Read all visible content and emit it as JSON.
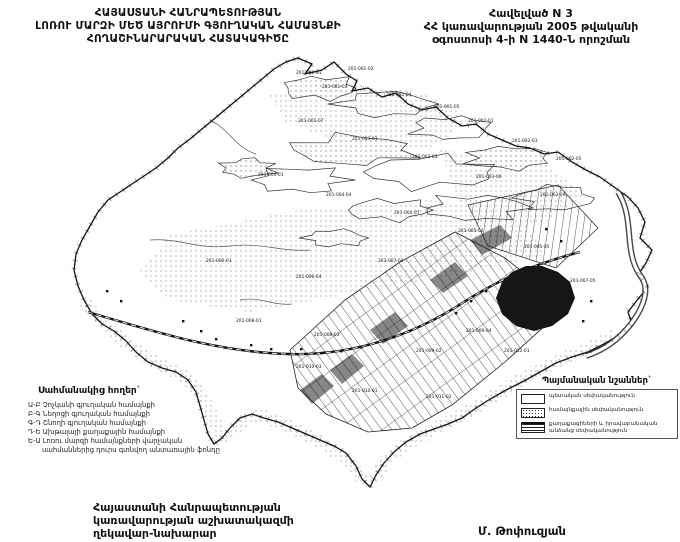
{
  "colors": {
    "ink": "#111111",
    "paper": "#ffffff",
    "map_gray": "#333333"
  },
  "header_left": {
    "lines": [
      "ՀԱՅԱՍՏԱՆԻ ՀԱՆՐԱՊԵՏՈՒԹՅԱՆ",
      "ԼՈՌՈՒ ՄԱՐԶԻ ՄԵԾ ԱՅՐՈՒՄԻ ԳՅՈՒՂԱԿԱՆ ՀԱՄԱՅՆՔԻ",
      "ՀՈՂԱՇԻՆԱՐԱՐԱԿԱՆ ՀԱՏԱԿԱԳԻԾԸ"
    ]
  },
  "header_right": {
    "lines": [
      "Հավելված N 3",
      "ՀՀ կառավարության 2005 թվականի",
      "օգոստոսի 4-ի N 1440-Ն որոշման"
    ]
  },
  "legend_border": {
    "heading": "Սահմանակից հողեր`",
    "items": [
      "Ա-Բ  Չոչկանի գյուղական համայնքի",
      "Բ-Գ  Նեղոցի գյուղական համայնքի",
      "Գ-Դ  Շնողի գյուղական համայնքի",
      "Դ-Ե  Ախթալայի քաղաքային համայնքի",
      "Ե-Ա  Լոռու մարզի համայնքների վարչական",
      "սահմաններից դուրս գտնվող անտառային ֆոնդը"
    ]
  },
  "legend_signs": {
    "heading": "Պայմանական նշաններ`",
    "items": [
      {
        "symbol": "state",
        "label": "պետական սեփականություն"
      },
      {
        "symbol": "community",
        "label": "համայնքային սեփականություն"
      },
      {
        "symbol": "private",
        "label": "քաղաքացիների և իրավաբանական անձանց սեփականություն"
      }
    ]
  },
  "footer": {
    "lines": [
      "Հայաստանի Հանրապետության",
      "կառավարության աշխատակազմի",
      "ղեկավար-նախարար"
    ]
  },
  "signature": "Մ. Թոփուզյան",
  "map": {
    "labels": [
      {
        "text": "201-001-01",
        "x": 296,
        "y": 74
      },
      {
        "text": "201-001-02",
        "x": 348,
        "y": 70
      },
      {
        "text": "201-001-03",
        "x": 322,
        "y": 88
      },
      {
        "text": "201-001-04",
        "x": 386,
        "y": 96
      },
      {
        "text": "201-001-05",
        "x": 434,
        "y": 108
      },
      {
        "text": "201-002-01",
        "x": 468,
        "y": 122
      },
      {
        "text": "201-002-03",
        "x": 512,
        "y": 142
      },
      {
        "text": "201-002-05",
        "x": 556,
        "y": 160
      },
      {
        "text": "201-001-07",
        "x": 298,
        "y": 122
      },
      {
        "text": "201-003-01",
        "x": 352,
        "y": 140
      },
      {
        "text": "201-003-03",
        "x": 412,
        "y": 158
      },
      {
        "text": "201-003-06",
        "x": 476,
        "y": 178
      },
      {
        "text": "201-003-09",
        "x": 540,
        "y": 196
      },
      {
        "text": "201-004-01",
        "x": 258,
        "y": 176
      },
      {
        "text": "201-004-04",
        "x": 326,
        "y": 196
      },
      {
        "text": "201-004-07",
        "x": 394,
        "y": 214
      },
      {
        "text": "201-005-02",
        "x": 458,
        "y": 232
      },
      {
        "text": "201-005-05",
        "x": 524,
        "y": 248
      },
      {
        "text": "201-006-01",
        "x": 206,
        "y": 262
      },
      {
        "text": "201-006-04",
        "x": 296,
        "y": 278
      },
      {
        "text": "201-007-02",
        "x": 378,
        "y": 262
      },
      {
        "text": "201-007-05",
        "x": 570,
        "y": 282
      },
      {
        "text": "201-008-01",
        "x": 236,
        "y": 322
      },
      {
        "text": "201-008-03",
        "x": 314,
        "y": 336
      },
      {
        "text": "201-009-02",
        "x": 416,
        "y": 352
      },
      {
        "text": "201-009-04",
        "x": 466,
        "y": 332
      },
      {
        "text": "201-010-01",
        "x": 352,
        "y": 392
      },
      {
        "text": "201-010-03",
        "x": 296,
        "y": 368
      },
      {
        "text": "201-011-02",
        "x": 426,
        "y": 398
      },
      {
        "text": "201-012-01",
        "x": 504,
        "y": 352
      }
    ]
  }
}
